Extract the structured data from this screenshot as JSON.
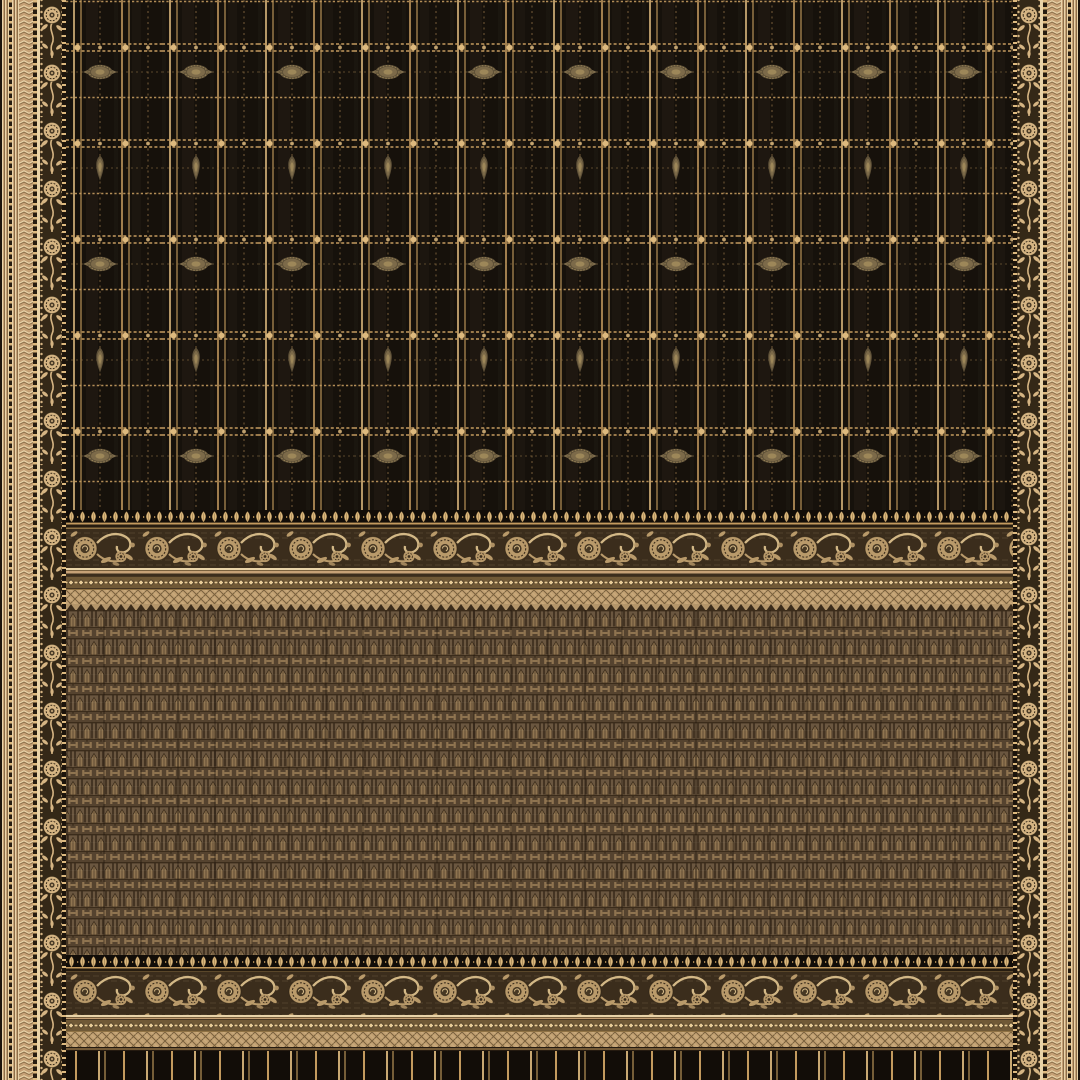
{
  "image": {
    "alt": "Black and gold silk saree: zari check body with oval and bud motifs, floral vine selvage borders, brown temple-weave brocade pallu framed by floral scroll and diamond lattice bands, striped black hem"
  },
  "sections": {
    "leftBorder": "left selvage border with woven floral vine and herringbone bands",
    "rightBorder": "right selvage border with woven floral vine and herringbone bands",
    "body": "black check body with gold zari grid, intersection dots, oval medallion rows and bud motif rows",
    "fringeTop": "gold bud fringe edging",
    "scrollTop": "floral scroll brocade band",
    "chainTop": "diamond chain band",
    "latticeTop": "diamond lattice band",
    "zigzagTop": "dark triangle edging",
    "pallu": "brown brocade pallu with alternating temple-arch and H-motif rows",
    "fringeBottom": "gold bud fringe edging",
    "scrollBottom": "floral scroll brocade band",
    "chainBottom": "diamond chain band",
    "latticeBottom": "diamond lattice band",
    "hem": "black hem with gold warp stripes"
  },
  "palette": {
    "bodyBlack": "#16110b",
    "bodyStreak": "#211a12",
    "zariBright": "#ddb97e",
    "zariMid": "#c39a5e",
    "zariDim": "#8f7244",
    "motifKhaki": "#7c6a49",
    "motifKhakiHi": "#9d8759",
    "motifKhakiLo": "#5f5138",
    "borderBeige": "#c6a176",
    "borderBeigeHi": "#e9d3a8",
    "borderBeigeLo": "#8c6f49",
    "borderDark": "#261c10",
    "vineBg": "#342817",
    "vineGold": "#d6b583",
    "scrollBg": "#3b2d1c",
    "scrollGold": "#b99a6a",
    "scrollGoldHi": "#d3b886",
    "chainBg": "#705936",
    "chainGold": "#e8cc96",
    "latticeBg": "#c2a173",
    "latticeLine": "#79603d",
    "palluBg": "#6b5740",
    "palluLight": "#8f7450",
    "palluMid": "#55432f",
    "palluDark": "#3b2c1b",
    "hemBlack": "#120d08",
    "zigGold": "#b3956a"
  }
}
